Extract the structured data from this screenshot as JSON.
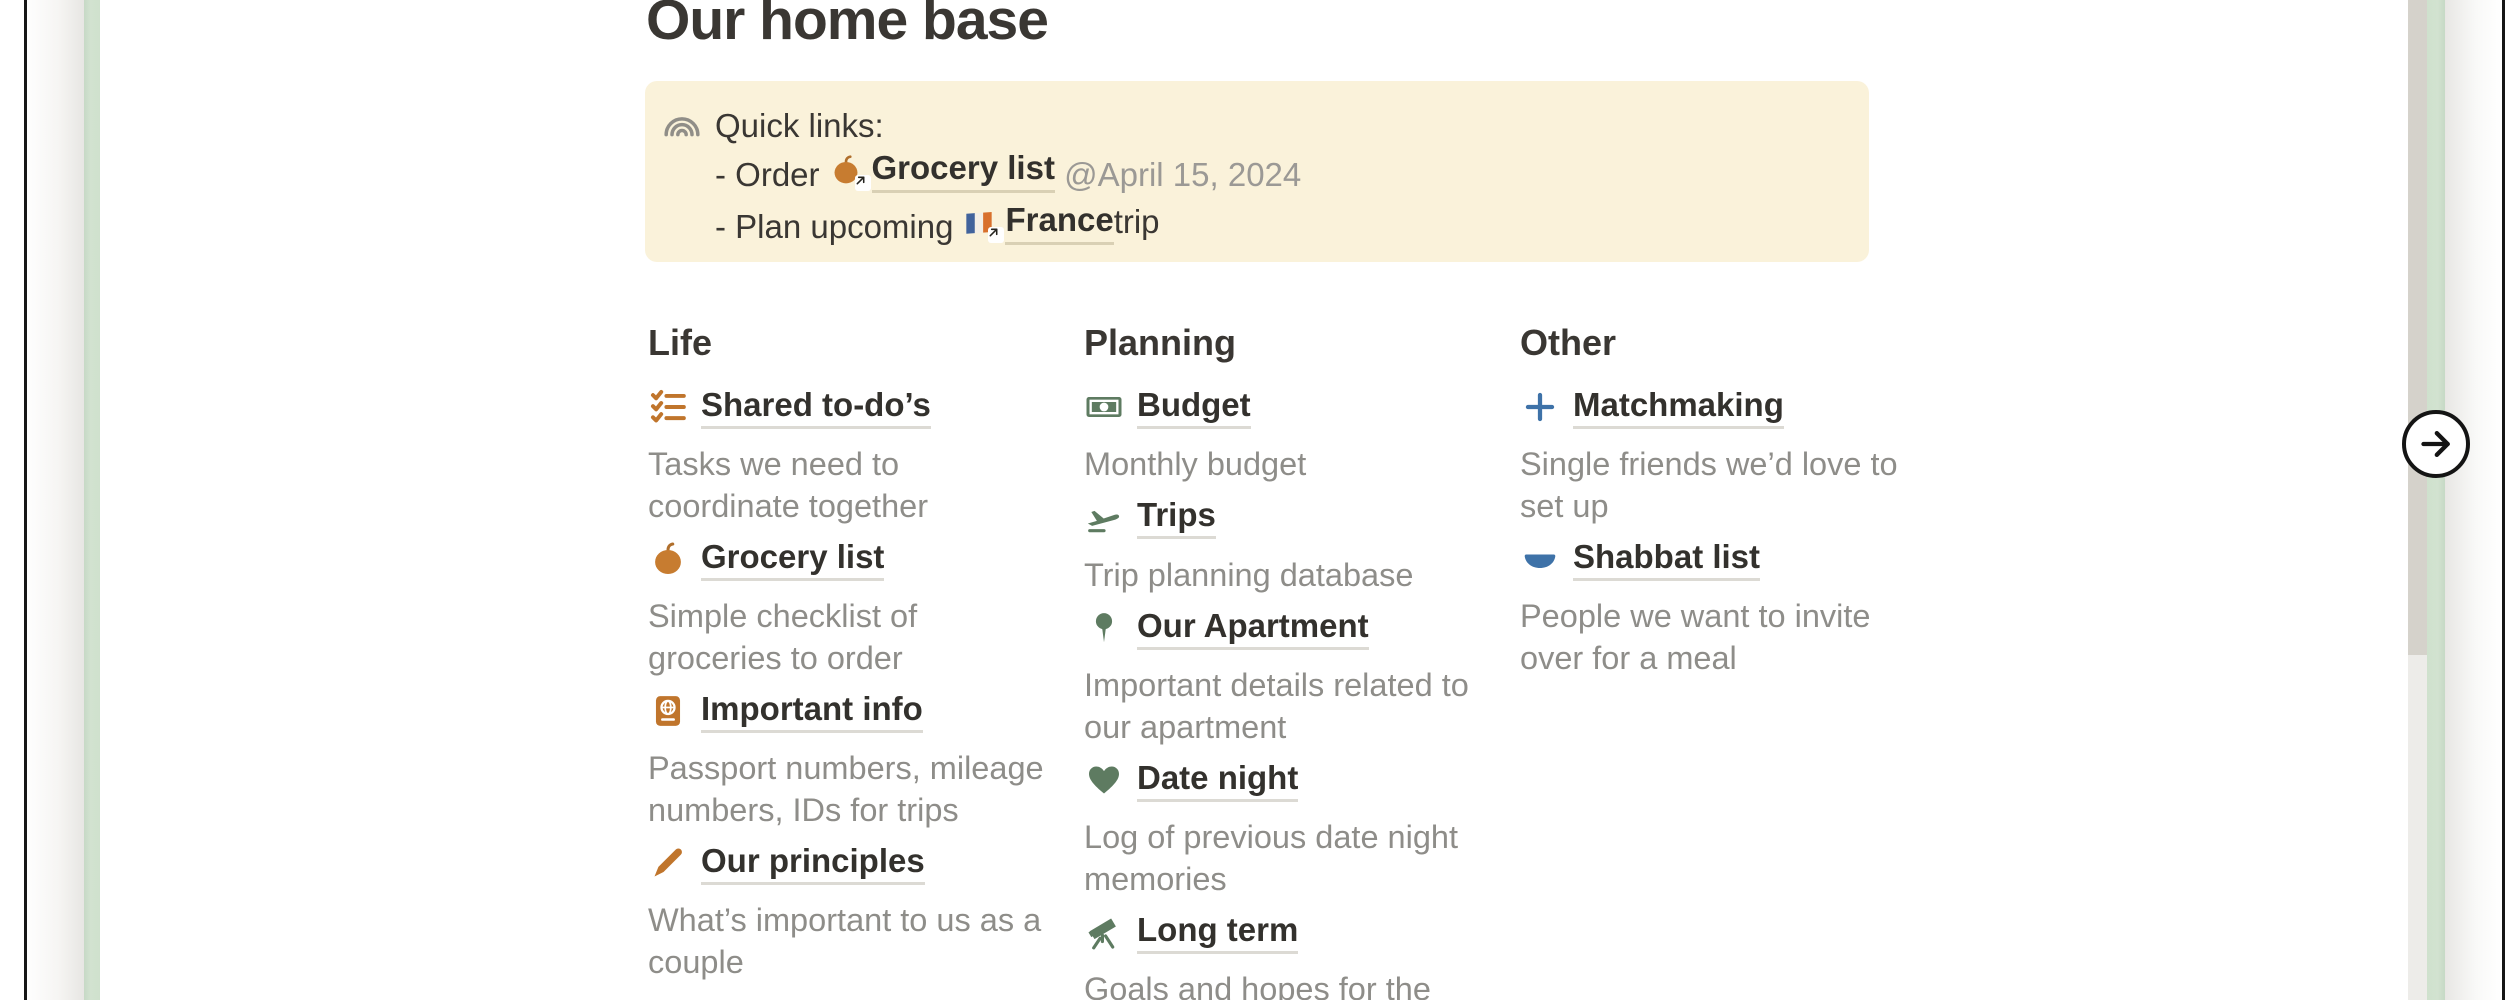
{
  "page": {
    "title": "Our home base"
  },
  "callout": {
    "icon": "rainbow-icon",
    "background": "#faf2da",
    "intro": "Quick links:",
    "item1": {
      "prefix": "- Order",
      "link_icon": "pumpkin-icon",
      "link_text": "Grocery list",
      "mention": "@April 15, 2024"
    },
    "item2": {
      "prefix": "- Plan upcoming",
      "link_icon": "france-flag-icon",
      "link_text": "France",
      "suffix": " trip"
    }
  },
  "columns": [
    {
      "heading": "Life",
      "accent_color": "#c0752c",
      "items": [
        {
          "icon": "checklist-icon",
          "label": "Shared to-do’s",
          "desc": "Tasks we need to\ncoordinate together"
        },
        {
          "icon": "pumpkin-icon",
          "label": "Grocery list",
          "desc": "Simple checklist of\ngroceries to order"
        },
        {
          "icon": "passport-icon",
          "label": "Important info",
          "desc": "Passport numbers, mileage\nnumbers, IDs for trips"
        },
        {
          "icon": "pencil-icon",
          "label": "Our principles",
          "desc": "What’s important to us as a\ncouple"
        }
      ]
    },
    {
      "heading": "Planning",
      "accent_color": "#5e7b61",
      "items": [
        {
          "icon": "money-icon",
          "label": "Budget",
          "desc": "Monthly budget"
        },
        {
          "icon": "airplane-icon",
          "label": "Trips",
          "desc": "Trip planning database"
        },
        {
          "icon": "pushpin-icon",
          "label": "Our Apartment",
          "desc": "Important details related to\nour apartment"
        },
        {
          "icon": "heart-icon",
          "label": "Date night",
          "desc": "Log of previous date night\nmemories"
        },
        {
          "icon": "telescope-icon",
          "label": "Long term",
          "desc": "Goals and hopes for the"
        }
      ]
    },
    {
      "heading": "Other",
      "accent_color": "#3e72a8",
      "items": [
        {
          "icon": "plus-icon",
          "label": "Matchmaking",
          "desc": "Single friends we’d love to\nset up"
        },
        {
          "icon": "bowl-icon",
          "label": "Shabbat list",
          "desc": "People we want to invite\nover for a meal"
        }
      ]
    }
  ],
  "nav": {
    "next_icon": "arrow-right-icon"
  },
  "colors": {
    "page_edge_green": "#cfe1cd",
    "card_border": "#161616",
    "link_underline": "#dcdad4",
    "description_text": "#8e8d89",
    "dark_text": "#3a3733"
  }
}
